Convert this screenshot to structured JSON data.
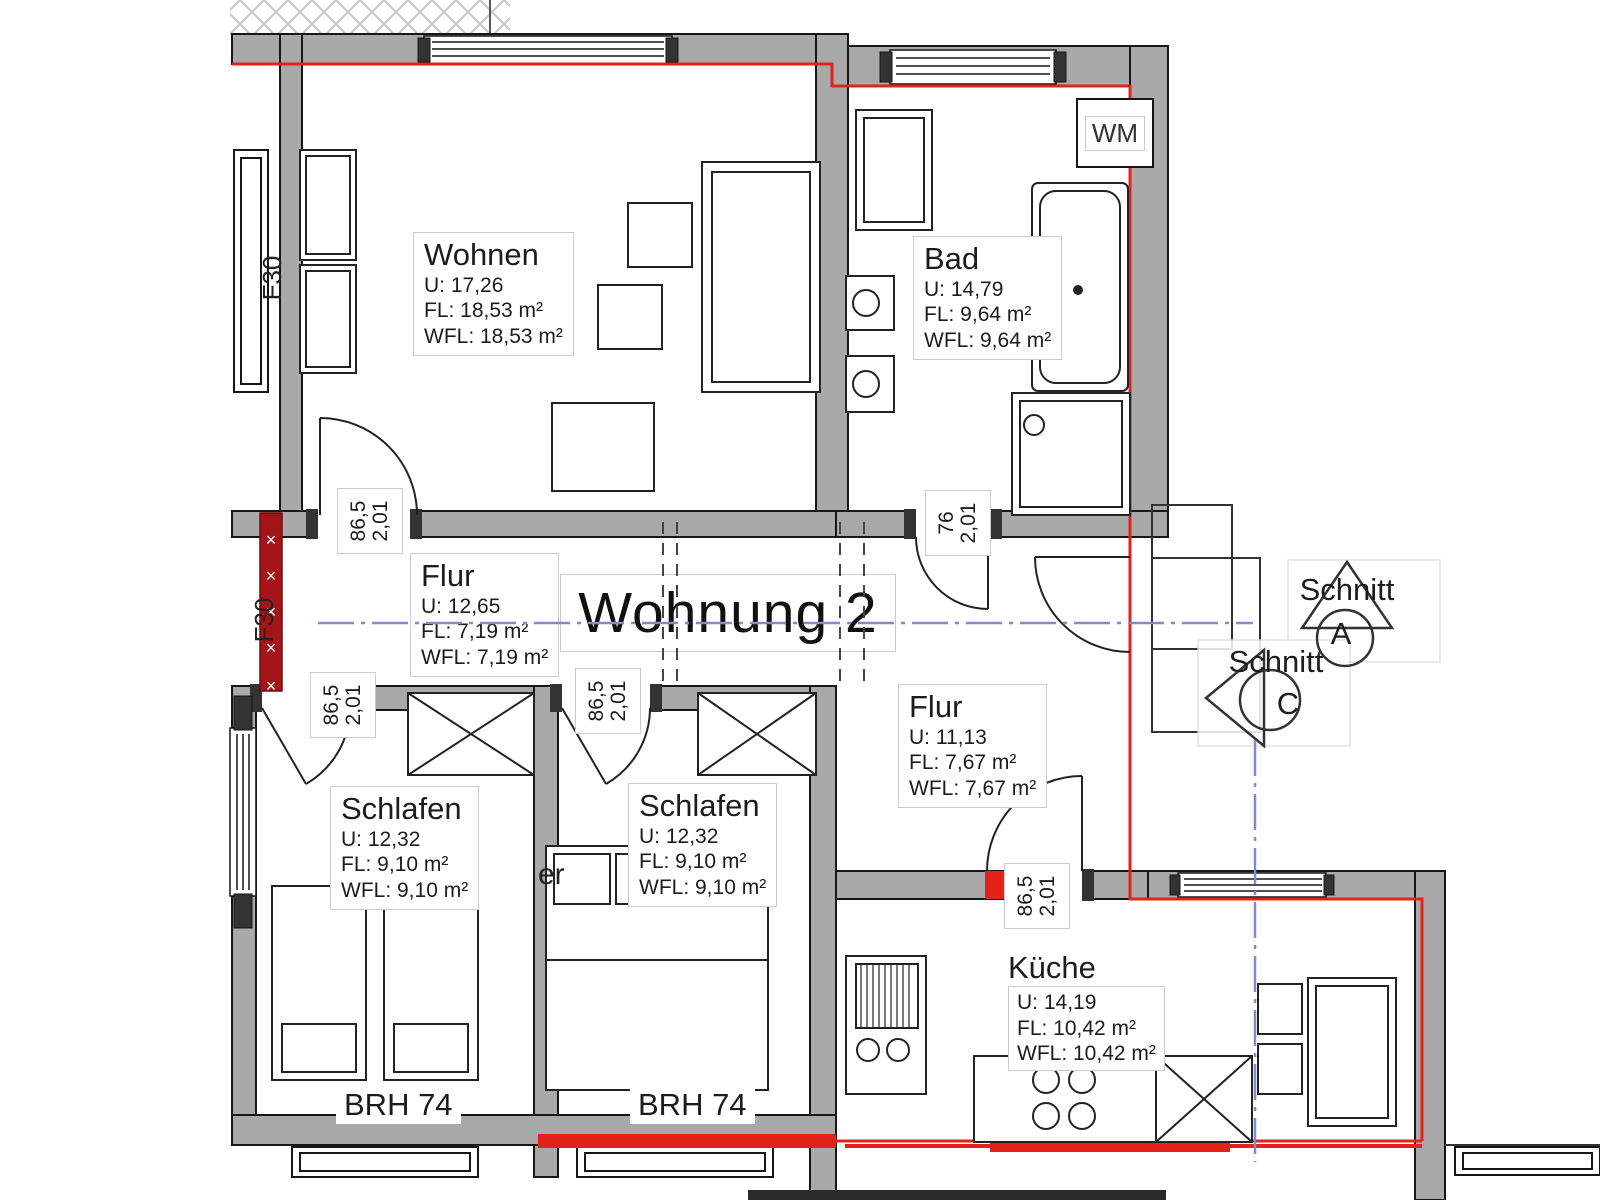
{
  "title": "Wohnung 2",
  "rooms": {
    "wohnen": {
      "name": "Wohnen",
      "u": "U: 17,26",
      "fl": "FL: 18,53 m²",
      "wfl": "WFL: 18,53 m²"
    },
    "bad": {
      "name": "Bad",
      "u": "U: 14,79",
      "fl": "FL: 9,64 m²",
      "wfl": "WFL: 9,64 m²"
    },
    "flur_oben": {
      "name": "Flur",
      "u": "U: 12,65",
      "fl": "FL: 7,19 m²",
      "wfl": "WFL: 7,19 m²"
    },
    "flur_unten": {
      "name": "Flur",
      "u": "U: 11,13",
      "fl": "FL: 7,67 m²",
      "wfl": "WFL: 7,67 m²"
    },
    "schlafen_links": {
      "name": "Schlafen",
      "u": "U: 12,32",
      "fl": "FL: 9,10 m²",
      "wfl": "WFL: 9,10 m²"
    },
    "schlafen_mitte": {
      "name": "Schlafen",
      "u": "U: 12,32",
      "fl": "FL: 9,10 m²",
      "wfl": "WFL: 9,10 m²"
    },
    "kueche": {
      "name": "Küche",
      "u": "U: 14,19",
      "fl": "FL: 10,42 m²",
      "wfl": "WFL: 10,42 m²"
    }
  },
  "doors": {
    "wohnen": {
      "w": "86,5",
      "h": "2,01"
    },
    "bad": {
      "w": "76",
      "h": "2,01"
    },
    "schlafen_links": {
      "w": "86,5",
      "h": "2,01"
    },
    "schlafen_mitte": {
      "w": "86,5",
      "h": "2,01"
    },
    "kueche": {
      "w": "86,5",
      "h": "2,01"
    }
  },
  "annotations": {
    "wm": "WM",
    "brh_links": "BRH 74",
    "brh_mitte": "BRH 74",
    "f30_oben": "F30",
    "f30_mitte": "F30",
    "fragment": "er"
  },
  "sections": {
    "a": {
      "label": "Schnitt",
      "letter": "A"
    },
    "c": {
      "label": "Schnitt",
      "letter": "C"
    }
  },
  "colors": {
    "wall": "#a9a9a9",
    "boundary_red": "#e3231a",
    "section_line_blue": "#8888c4",
    "fire_wall_red": "#a51418"
  }
}
